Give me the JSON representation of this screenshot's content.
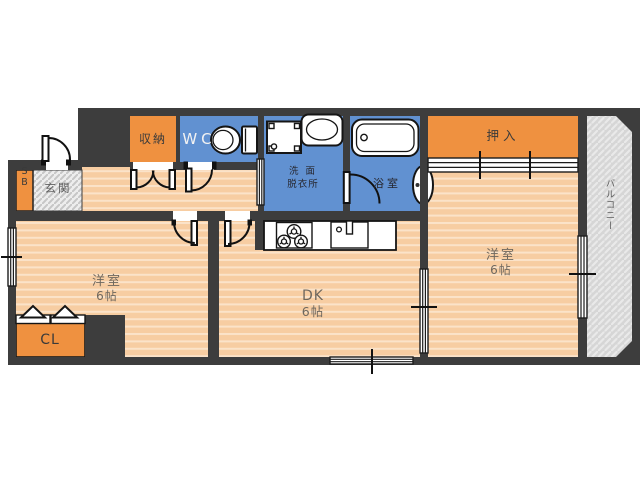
{
  "floorplan": {
    "rooms": {
      "bedroom_left": {
        "name": "洋室",
        "size": "6帖"
      },
      "dk": {
        "name": "DK",
        "size": "6帖"
      },
      "bedroom_right": {
        "name": "洋室",
        "size": "6帖"
      },
      "oshiire": {
        "label": "押入"
      },
      "storage": {
        "label": "収納"
      },
      "wc": {
        "label": "WC"
      },
      "washroom": {
        "line1": "洗 面",
        "line2": "脱衣所"
      },
      "bathroom": {
        "label": "浴室"
      },
      "entrance": {
        "label": "玄関"
      },
      "shoe_box": {
        "label": "SB"
      },
      "closet_cl": {
        "label": "CL"
      },
      "balcony": {
        "label": "バルコニー"
      }
    },
    "fixtures": {
      "toilet": "toilet-icon",
      "bathtub": "bathtub-icon",
      "washing_machine_pan": "washing-machine-icon",
      "wash_basin": "sink-basin-icon",
      "bath_basin": "bath-basin-icon",
      "stove": "gas-stove-icon",
      "kitchen_sink": "kitchen-sink-icon",
      "closet_folding_doors": "folding-door-icon"
    },
    "colors": {
      "wall": "#3d3d3d",
      "floor_base": "#f7cda2",
      "floor_stripe": "#fbe3c9",
      "storage_orange": "#ef9140",
      "wet_area_blue": "#6191d1",
      "balcony_gray": "#d6d6d6",
      "entrance_gray": "#ededed",
      "label_dark": "#3a3a3a",
      "label_floor": "#6e675e"
    }
  }
}
